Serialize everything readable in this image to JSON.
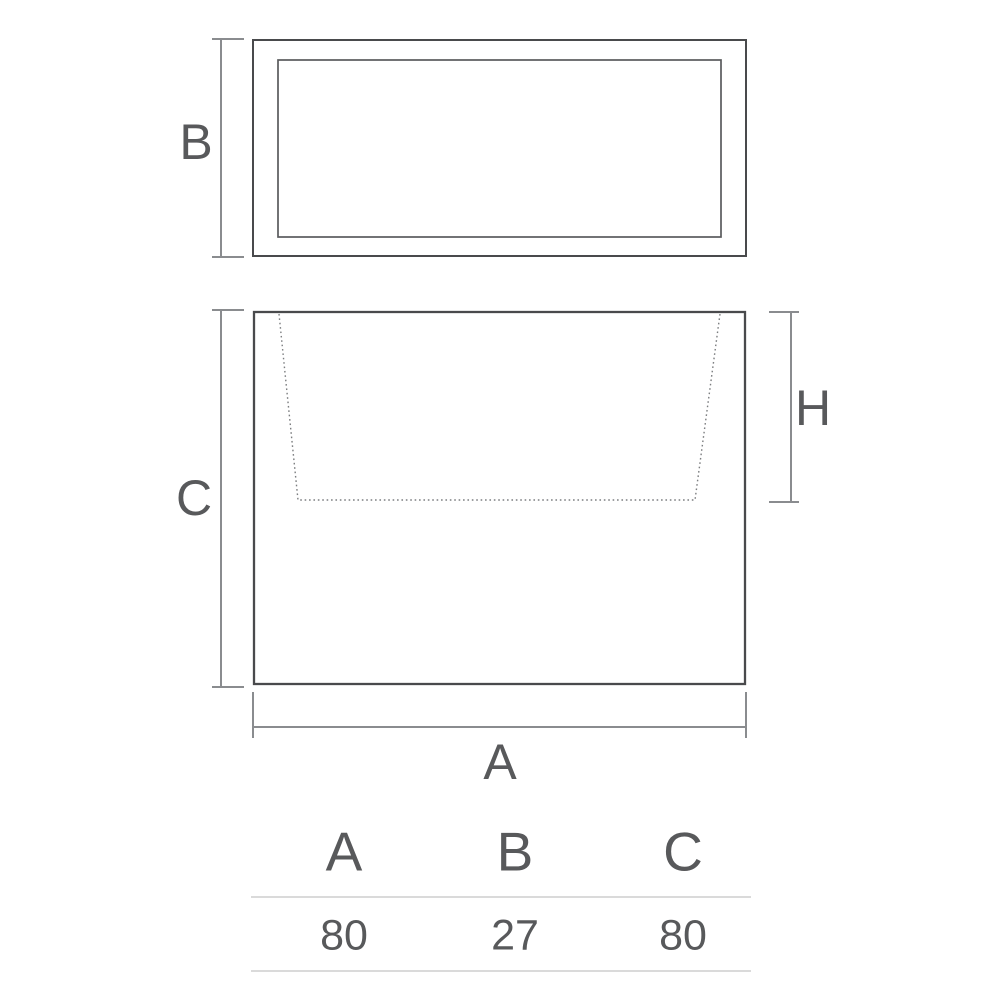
{
  "figure": {
    "top_view": {
      "dimension_label": "B"
    },
    "front_view": {
      "height_label": "C",
      "inner_depth_label": "H",
      "width_label": "A"
    }
  },
  "spec_table": {
    "headers": [
      "A",
      "B",
      "C"
    ],
    "values": [
      "80",
      "27",
      "80"
    ]
  },
  "colors": {
    "outline": "#494a4c",
    "outline_inner": "#5a5b5d",
    "dimension": "#8a8c8f",
    "dotted": "#7c7e80",
    "text": "#58595b",
    "table_rule": "#dadada"
  }
}
